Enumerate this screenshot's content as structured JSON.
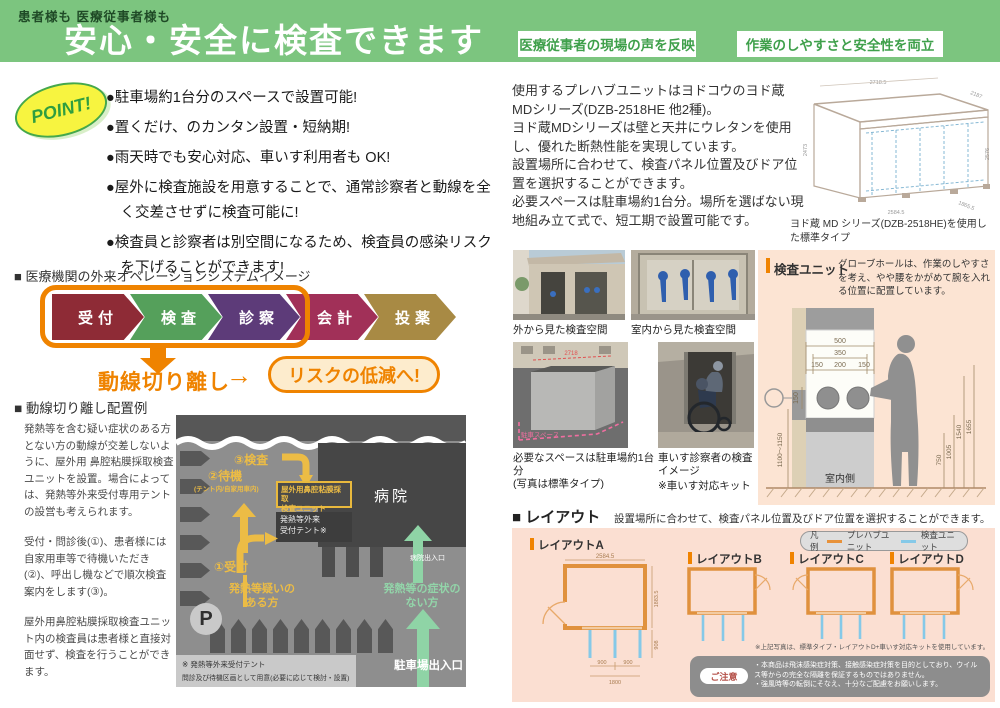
{
  "accent_orange": "#ef8300",
  "header": {
    "green": "#7cc57f",
    "supertitle": "患者様も 医療従事者様も",
    "title": "安心・安全に検査できます",
    "badge1": "医療従事者の現場の声を反映",
    "badge2": "作業のしやすさと安全性を両立"
  },
  "points": {
    "badge": "POINT!",
    "items": [
      "●駐車場約1台分のスペースで設置可能!",
      "●置くだけ、のカンタン設置・短納期!",
      "●雨天時でも安心対応、車いす利用者も OK!",
      "●屋外に検査施設を用意することで、通常診察者と動線を全く交差させずに検査可能に!",
      "●検査員と診察者は別空間になるため、検査員の感染リスクを下げることができます!"
    ]
  },
  "flow": {
    "heading": "■ 医療機関の外来オペレーションシステムイメージ",
    "steps": [
      {
        "label": "受付",
        "color": "#8e2b36"
      },
      {
        "label": "検査",
        "color": "#55a05b"
      },
      {
        "label": "診察",
        "color": "#5d3b79"
      },
      {
        "label": "会計",
        "color": "#a13058"
      },
      {
        "label": "投薬",
        "color": "#a88a44"
      }
    ],
    "separation": "動線切り離し",
    "arrow": "→",
    "result": "リスクの低減へ!"
  },
  "example": {
    "heading": "■ 動線切り離し配置例",
    "p1": "発熱等を含む疑い症状のある方とない方の動線が交差しないように、屋外用 鼻腔粘膜採取検査ユニットを設置。場合によっては、発熱等外来受付専用テントの設営も考えられます。",
    "p2": "受付・問診後(①)、患者様には自家用車等で待機いただき(②)、呼出し機などで順次検査案内をします(③)。",
    "p3": "屋外用鼻腔粘膜採取検査ユニット内の検査員は患者様と直接対面せず、検査を行うことができます。",
    "map": {
      "hospital": "病院",
      "hospital_gate": "病院出入口",
      "step3": "③検査",
      "step2": "②待機",
      "step2_note": "(テント内/自家用車内)",
      "unit_line1": "屋外用鼻腔粘膜採取",
      "unit_line2": "検査ユニット",
      "tent_line1": "発熱等外来",
      "tent_line2": "受付テント※",
      "step1": "①受付",
      "fever_line1": "発熱等疑いの",
      "fever_line2": "ある方",
      "healthy_line1": "発熱等の症状の",
      "healthy_line2": "ない方",
      "parking_gate": "駐車場出入口",
      "parking_mark": "P",
      "note_line1": "※ 発熱等外来受付テント",
      "note_line2": "問診及び待機区画として用意(必要に応じて検討・設置)"
    }
  },
  "unit_info": {
    "p1": "使用するプレハブユニットはヨドコウのヨド蔵MDシリーズ(DZB-2518HE 他2種)。",
    "p2": "ヨド蔵MDシリーズは壁と天井にウレタンを使用し、優れた断熱性能を実現しています。",
    "p3": "設置場所に合わせて、検査パネル位置及びドア位置を選択することができます。",
    "p4": "必要スペースは駐車場約1台分。場所を選ばない現地組み立て式で、短工期で設置可能です。",
    "drawing": {
      "caption": "ヨド蔵 MD シリーズ(DZB-2518HE)を使用した標準タイプ",
      "dim_top": "2718.5",
      "dim_top_right": "2187",
      "dim_left": "2473",
      "dim_right": "2576",
      "dim_bottom": "2584.5",
      "dim_bottom_right": "1865.5"
    }
  },
  "photos": {
    "cap1": "外から見た検査空間",
    "cap2": "室内から見た検査空間",
    "cap3a": "必要なスペースは駐車場約1台分",
    "cap3b": "(写真は標準タイプ)",
    "cap4": "車いす診察者の検査イメージ",
    "cap4_note": "※車いす対応キット",
    "photo3_dim": "2718",
    "photo3_label": "駐車スペース"
  },
  "inspection": {
    "title": "検査ユニット",
    "desc": "グローブホールは、作業のしやすさを考え、やや腰をかがめて腕を入れる位置に配置しています。",
    "room_side": "室内側",
    "d500": "500",
    "d350": "350",
    "d150a": "150",
    "d200": "200",
    "d150b": "150",
    "d150h": "150",
    "dwall": "1100〜1150",
    "d750": "750",
    "d1005": "1005",
    "d1540": "1540",
    "d1655": "1655"
  },
  "layouts": {
    "heading": "■ レイアウト",
    "sub": "設置場所に合わせて、検査パネル位置及びドア位置を選択することができます。",
    "legend_title": "凡例",
    "legend1": "プレハブユニット",
    "legend1_color": "#e8923a",
    "legend2": "検査ユニット",
    "legend2_color": "#85c9e8",
    "a": "レイアウトA",
    "b": "レイアウトB",
    "c": "レイアウトC",
    "d": "レイアウトD",
    "a_top": "2584.5",
    "a_right1": "1883.5",
    "a_right2": "908",
    "a_b1": "900",
    "a_b2": "900",
    "a_total": "1800",
    "footnote": "※上記写真は、標準タイプ・レイアウトD+車いす対応キットを使用しています。",
    "notice_title": "ご注意",
    "notice1": "・本商品は飛沫感染症対策、接触感染症対策を目的としており、ウイルス等からの完全な隔離を保証するものではありません。",
    "notice2": "・強風時等の転倒にそなえ、十分なご配慮をお願いします。"
  }
}
